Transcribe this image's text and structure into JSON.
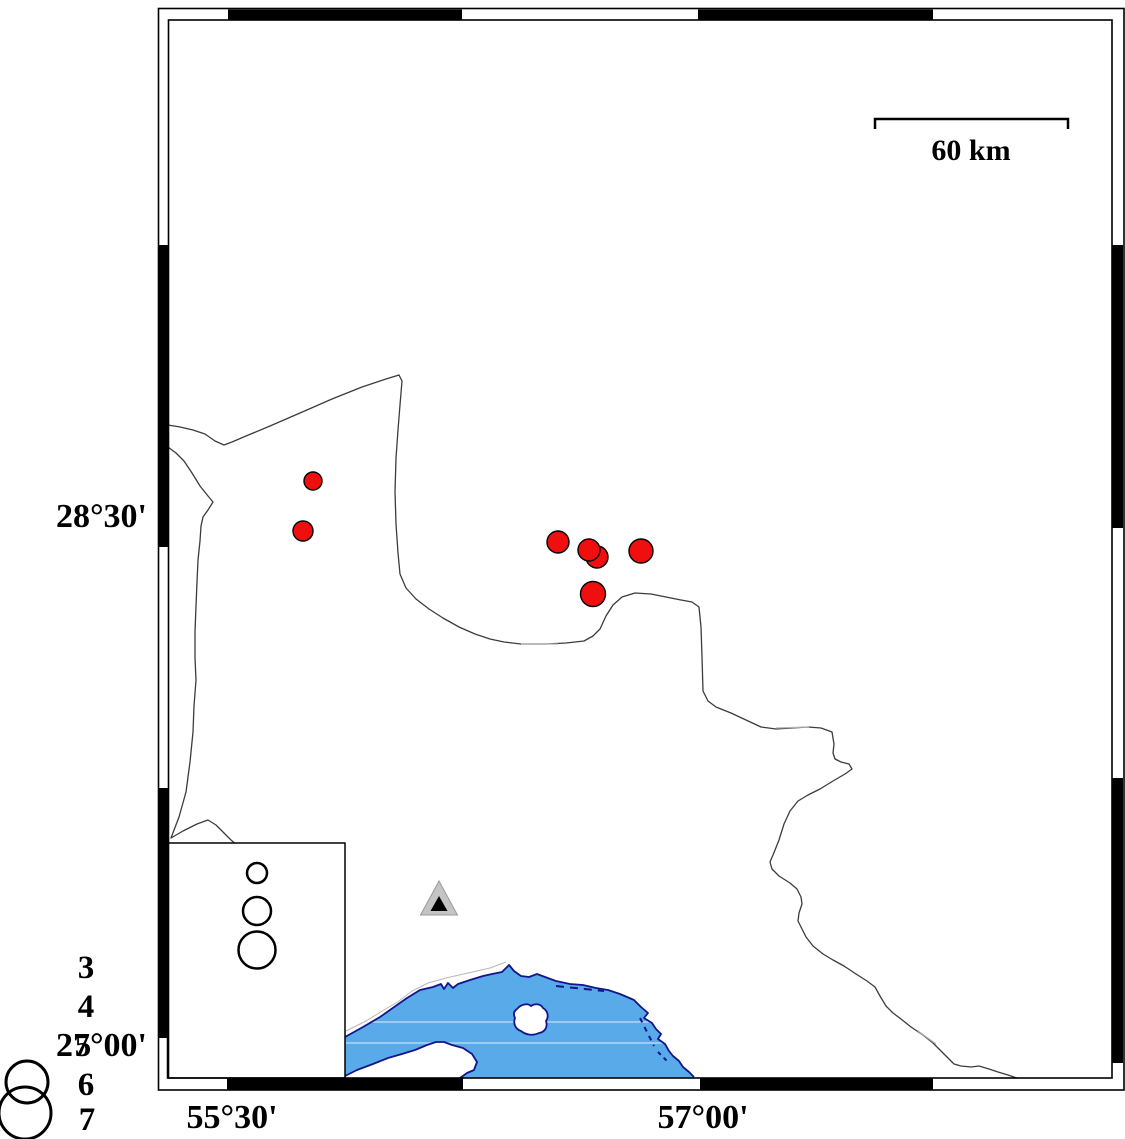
{
  "figure": {
    "type": "seismicity-map",
    "width_px": 1125,
    "height_px": 1139
  },
  "frame": {
    "lat_annotations": [
      {
        "text": "28°30'"
      },
      {
        "text": "27°00'"
      }
    ],
    "lon_annotations": [
      {
        "text": "55°30'"
      },
      {
        "text": "57°00'"
      }
    ]
  },
  "scalebar": {
    "label": "60 km"
  },
  "legend": {
    "magnitude_labels": [
      "3",
      "4",
      "5",
      "6",
      "7"
    ],
    "circles": [
      {
        "x": 257,
        "y": 873,
        "r": 10,
        "stroke": 2.5
      },
      {
        "x": 257,
        "y": 911,
        "r": 14,
        "stroke": 2.5
      },
      {
        "x": 257,
        "y": 950,
        "r": 18.5,
        "stroke": 2.5
      },
      {
        "x": 27,
        "y": 1082,
        "r": 21,
        "stroke": 3
      },
      {
        "x": 25,
        "y": 1113,
        "r": 26,
        "stroke": 3
      }
    ]
  },
  "map_data": {
    "earthquake_epicenters": [
      {
        "x": 313,
        "y": 481,
        "r": 9
      },
      {
        "x": 303,
        "y": 531,
        "r": 10
      },
      {
        "x": 558,
        "y": 542,
        "r": 11
      },
      {
        "x": 597,
        "y": 557,
        "r": 11
      },
      {
        "x": 589,
        "y": 550,
        "r": 11
      },
      {
        "x": 641,
        "y": 551,
        "r": 12
      },
      {
        "x": 593,
        "y": 594,
        "r": 12.5
      }
    ],
    "station": {
      "x": 439,
      "y": 899
    }
  },
  "colors": {
    "sea": "#58aae8",
    "coastline": "#14148c",
    "epicenter": "#f10e0e",
    "boundary": "#3c3c3c",
    "station": "#c4c4c4"
  }
}
